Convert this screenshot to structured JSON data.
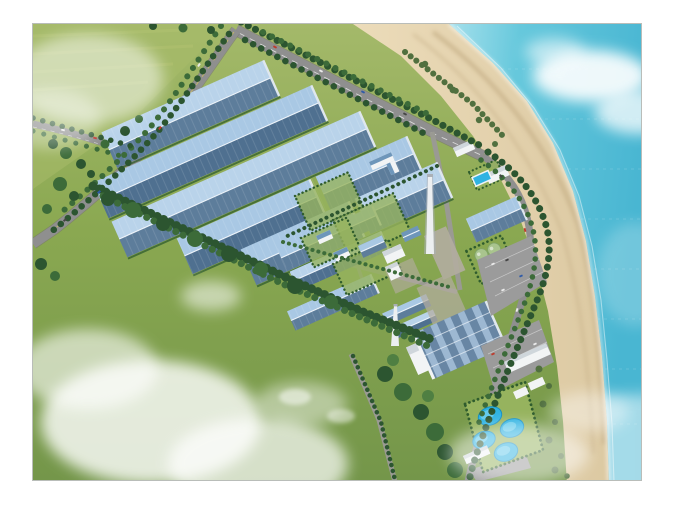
{
  "meta": {
    "description": "Aerial architectural rendering of a coastal industrial plant: rows of long blue-roofed factory halls, green fields and tree-lined roads on the left, a central utility campus with chimneys and storage tanks, a large striped warehouse, parking lots, four round blue treatment ponds, and a curving sandy beach with turquoise sea on the right under scattered white clouds."
  },
  "scene": {
    "setting": "coastal industrial plant, oblique aerial view",
    "large_factory_halls": 5,
    "small_factory_halls": 8,
    "circular_ponds": 4,
    "storage_tanks": 4,
    "chimneys": 2,
    "parking_lots": 3,
    "swimming_pool": 1,
    "roads": [
      "coast road",
      "west diagonal road",
      "west branch road",
      "shore perimeter road",
      "internal plant roads"
    ],
    "water": "sea along the east edge with sandy beach",
    "vegetation": [
      "tree rows along all roads",
      "dense tree band on the south boundary",
      "large open green field",
      "hedged campus lawns"
    ],
    "clouds": "soft white clouds over the field, the beach and the sea"
  },
  "colors": {
    "page_bg": "#ffffff",
    "frame_border": "#b9bdb9",
    "grass_hi": "#a4b96a",
    "grass": "#8aa851",
    "grass_dark": "#74964a",
    "lawn": "#96b35e",
    "tree_dark": "#2c5530",
    "tree_mid": "#3c6b39",
    "tree_light": "#4f7f42",
    "bush_olive": "#51703f",
    "hedge": "#2f5c2d",
    "road": "#8f8f8f",
    "road_dark": "#76746f",
    "road_int": "#9a9a93",
    "road_line": "#e8e8e8",
    "road_yellow": "#d8c85a",
    "hall_light": "#a9c8e4",
    "hall_light2": "#b9d3ea",
    "hall_dark": "#5d7d9b",
    "hall_dark2": "#4f7090",
    "ridge": "#eef4fa",
    "endwall": "#dfe7ee",
    "wall_white": "#f2f4f5",
    "roof_grey": "#cfd6db",
    "roof_blue": "#6e96ba",
    "concrete": "#b3ada0",
    "stack_white": "#eceff1",
    "stack_shade": "#aab0b6",
    "tank_green": "#a9c48e",
    "tank_dark": "#7fa369",
    "parking": "#9b9b9b",
    "parking_line": "#d2d2d2",
    "pond": "#2fb3e2",
    "pond_light": "#8edcf2",
    "pond_dark": "#1590c4",
    "sand": "#dcc9a2",
    "sand_light": "#ecdcba",
    "sand_wet": "#c6b088",
    "sea_near": "#a5e0ec",
    "sea_mid": "#66c8dc",
    "sea_deep": "#49b6d2",
    "sea_haze": "#d8f0f2",
    "foam": "#ffffff",
    "cloud": "#ffffff",
    "car_red": "#c0392b",
    "car_blue": "#2e5aa8",
    "car_white": "#ececec",
    "car_dark": "#444444"
  }
}
